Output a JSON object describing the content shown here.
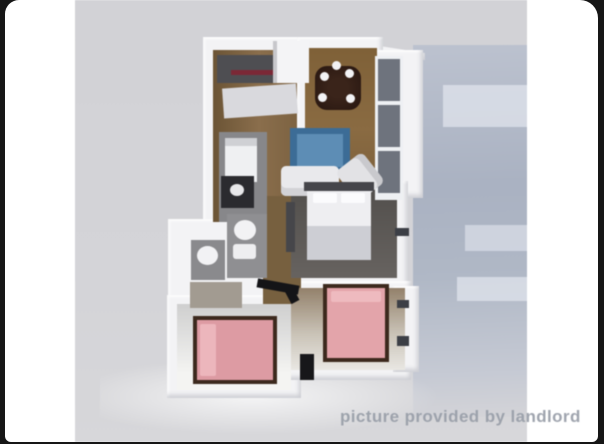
{
  "watermark": {
    "text": "picture provided by landlord"
  },
  "image": {
    "description": "3D rendered top-down floor plan of a two-bedroom apartment, photo provided by landlord",
    "rooms": [
      "kitchen",
      "dining-area",
      "living-area",
      "laundry-powder-room",
      "bathroom",
      "hallway",
      "bedroom-middle",
      "bedroom-right",
      "bedroom-left",
      "window-wall-balcony"
    ],
    "furniture": [
      "kitchen-counter-with-stove",
      "refrigerator",
      "washer",
      "bathroom-vanity",
      "round-dining-table-with-place-settings",
      "blue-sofa",
      "white-loveseat",
      "white-armchair",
      "white-bed",
      "pink-bed-vertical",
      "pink-bed-horizontal",
      "dresser",
      "toilets",
      "sink"
    ]
  },
  "colors": {
    "frame": "#161616",
    "photo_bg": "#ffffff",
    "backdrop_gray": "#d3d3d7",
    "shadow_panel": "#aeb6c4",
    "wall_white": "#f3f3f5",
    "wood_floor": "#84653c",
    "sofa_blue": "#3c6c96",
    "bed_pink": "#e3a4aa",
    "accent_red": "#7b2836",
    "watermark": "#9aa0aa"
  }
}
